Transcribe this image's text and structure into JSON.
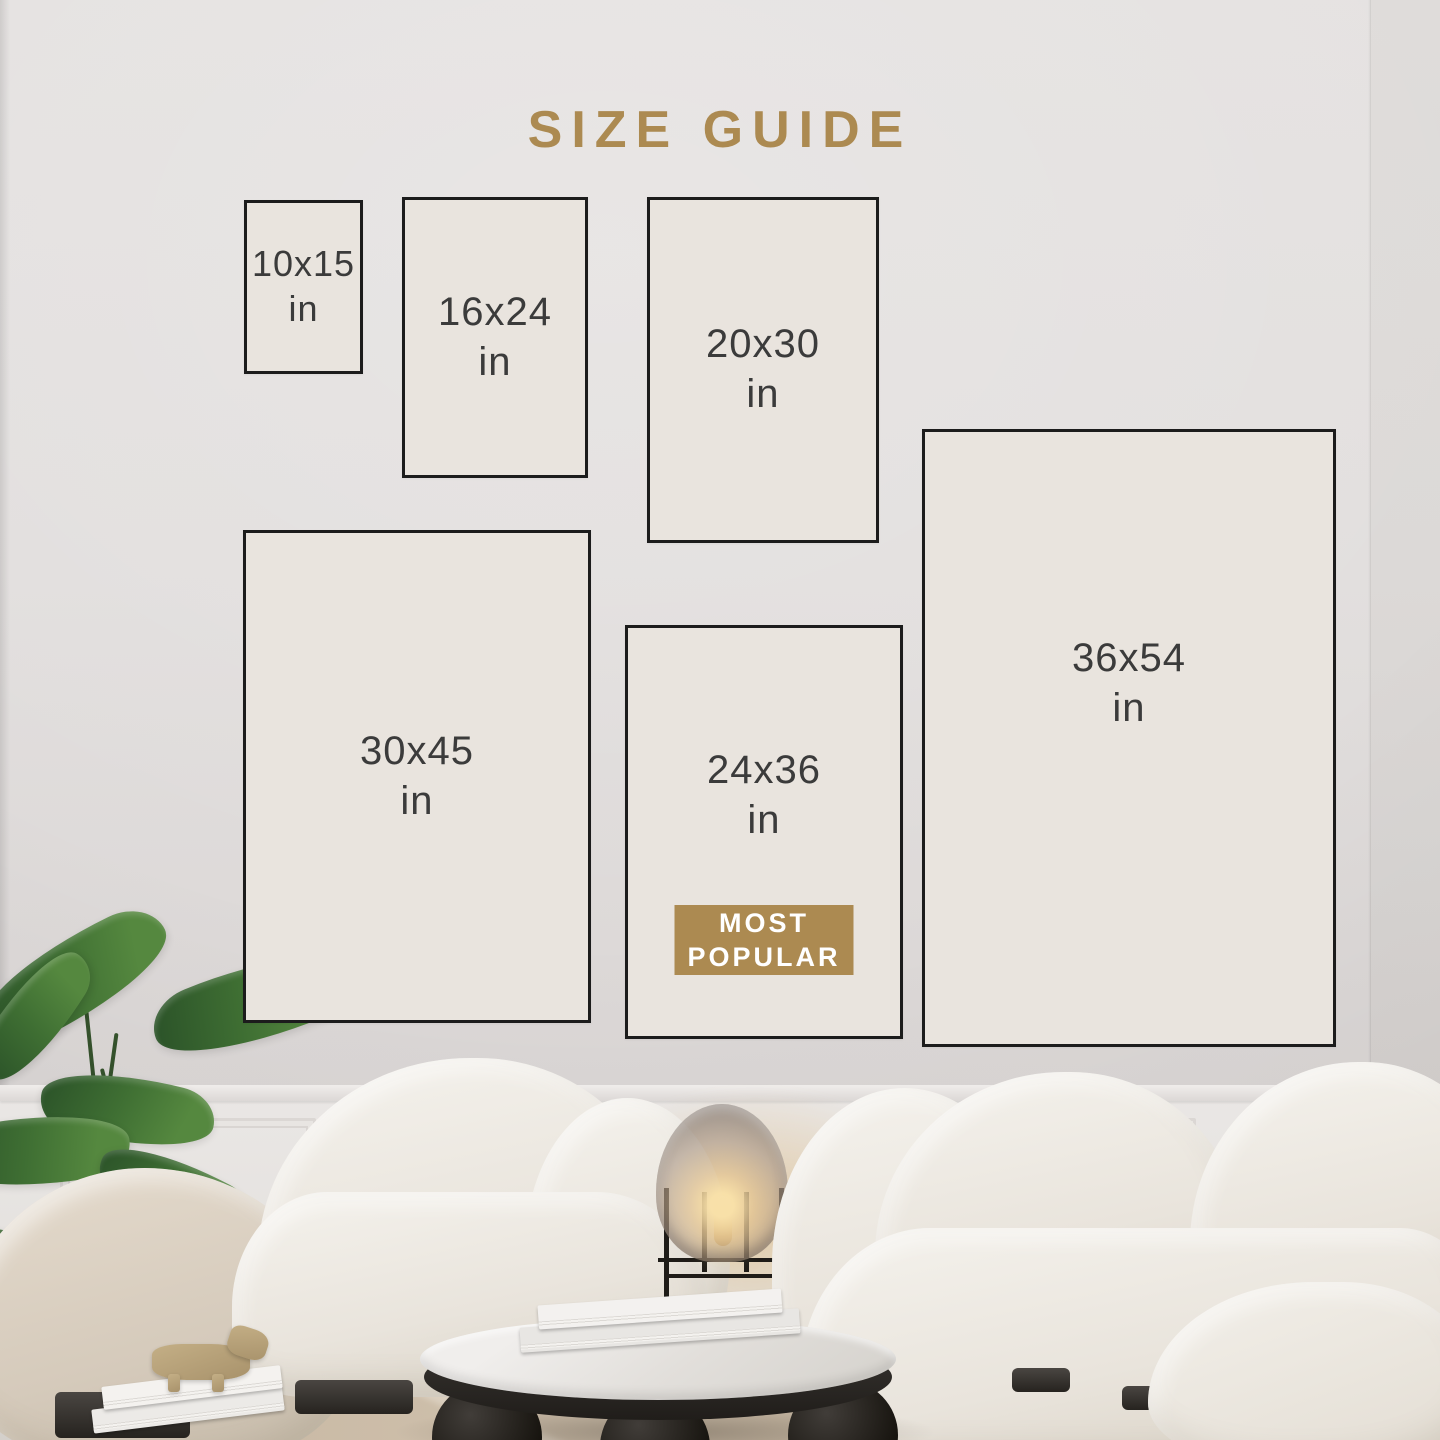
{
  "title": "SIZE GUIDE",
  "sizes": [
    {
      "label": "10x15",
      "unit": "in"
    },
    {
      "label": "16x24",
      "unit": "in"
    },
    {
      "label": "20x30",
      "unit": "in"
    },
    {
      "label": "30x45",
      "unit": "in"
    },
    {
      "label": "24x36",
      "unit": "in",
      "badge": "MOST POPULAR"
    },
    {
      "label": "36x54",
      "unit": "in"
    }
  ],
  "badge": {
    "line1": "MOST",
    "line2": "POPULAR"
  },
  "colors": {
    "accent": "#ac8a51",
    "box_border": "#1c1c1c",
    "box_fill": "#e9e4de",
    "label_text": "#3b3b3b",
    "badge_text": "#ffffff"
  }
}
